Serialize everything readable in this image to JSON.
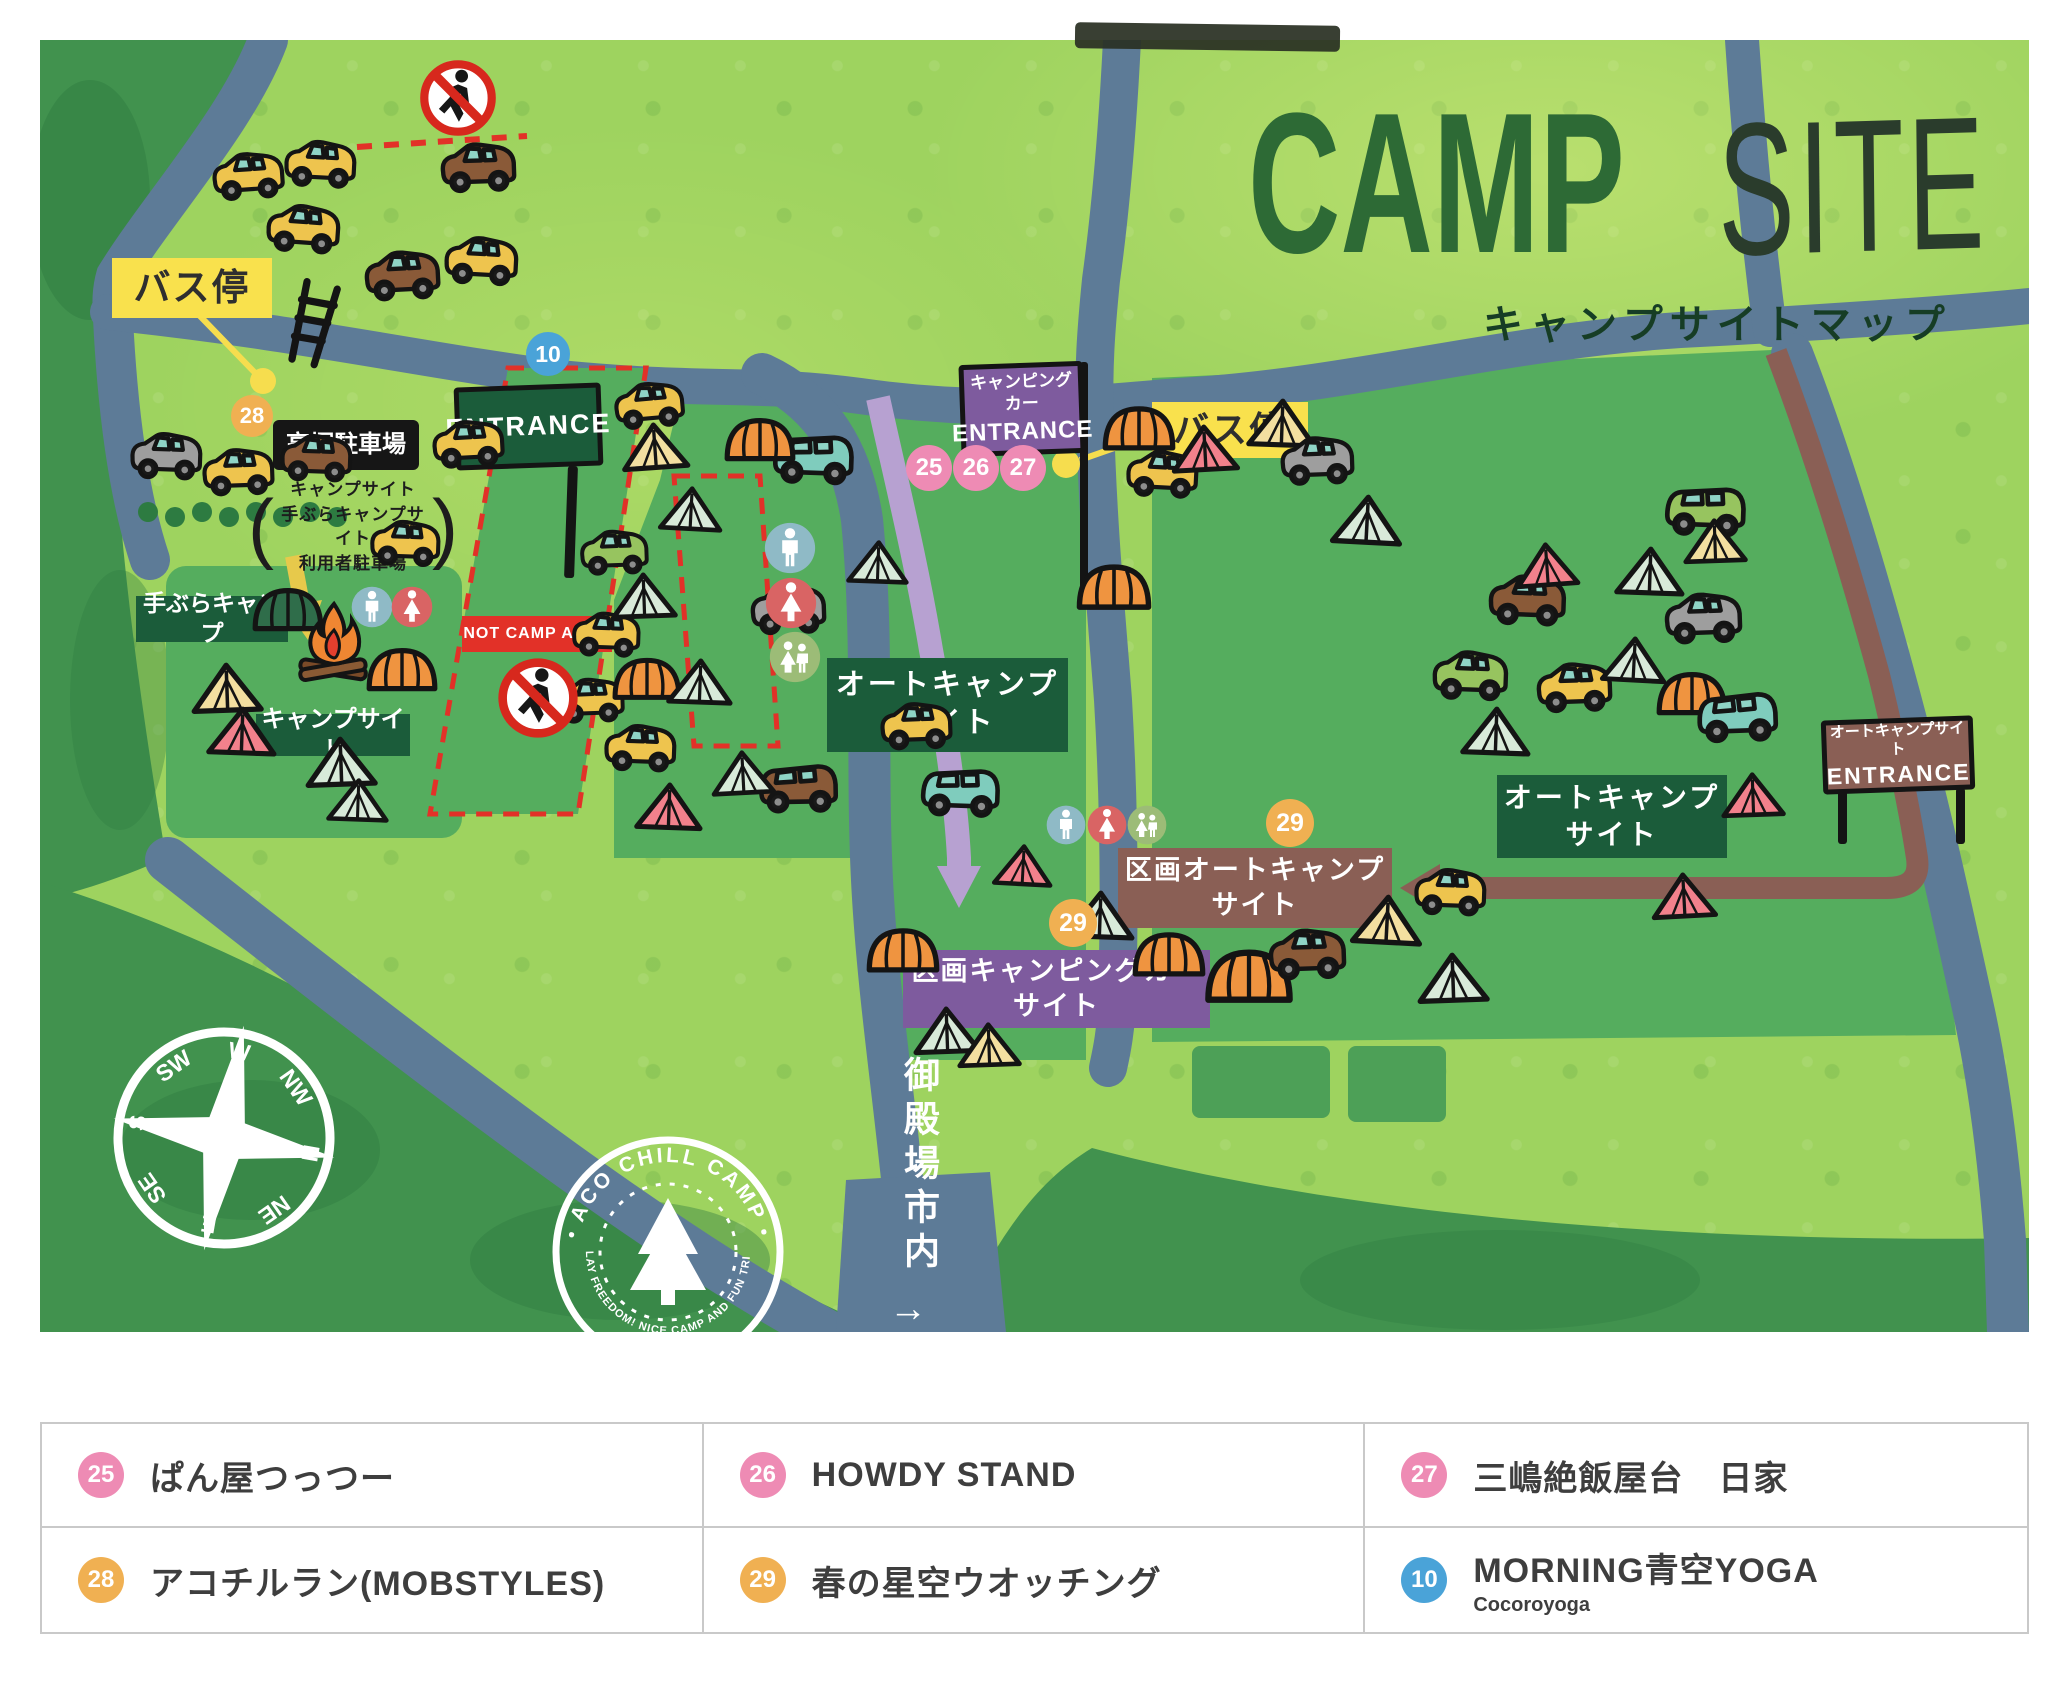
{
  "title": {
    "camp": "CAMP",
    "site": "SITE",
    "subtitle": "キャンプサイトマップ"
  },
  "labels": {
    "bus_stop_left": "バス停",
    "bus_stop_right": "バス停",
    "entrance_main": "ENTRANCE",
    "camper_entrance_line1": "キャンピングカー",
    "camper_entrance_line2": "ENTRANCE",
    "auto_entrance_line1": "オートキャンプサイト",
    "auto_entrance_line2": "ENTRANCE",
    "parking_name": "高塚駐車場",
    "parking_note_line1": "キャンプサイト",
    "parking_note_line2": "手ぶらキャンプサイト",
    "parking_note_line3": "利用者駐車場",
    "paren_open": "(",
    "paren_close": ")",
    "tebura_camp": "手ぶらキャンプ",
    "campsite_area": "キャンプサイト",
    "auto_center_line1": "オートキャンプ",
    "auto_center_line2": "サイト",
    "auto_right_line1": "オートキャンプ",
    "auto_right_line2": "サイト",
    "kukaku_camper_line1": "区画キャンピングカー",
    "kukaku_camper_line2": "サイト",
    "kukaku_auto_line1": "区画オートキャンプ",
    "kukaku_auto_line2": "サイト",
    "not_camp": "NOT CAMP AREA",
    "gotemba": "御殿場市内",
    "gotemba_arrow": "→"
  },
  "colors": {
    "pink": "#ee8bb4",
    "orange": "#f0b052",
    "blue": "#4aa3d8",
    "yellow": "#f6dd4e",
    "green_dark": "#1b5c3a",
    "purple": "#7e5b9e",
    "brown": "#8a5f55",
    "red": "#e23128",
    "road": "#5d7b97",
    "lavender": "#b7a1d1",
    "forest": "#41924e"
  },
  "badges": [
    {
      "label": "10",
      "color": "blue",
      "x": 548,
      "y": 354,
      "d": 44
    },
    {
      "label": "25",
      "color": "pink",
      "x": 929,
      "y": 468,
      "d": 46
    },
    {
      "label": "26",
      "color": "pink",
      "x": 976,
      "y": 468,
      "d": 46
    },
    {
      "label": "27",
      "color": "pink",
      "x": 1023,
      "y": 468,
      "d": 46
    },
    {
      "label": "28",
      "color": "orange",
      "x": 252,
      "y": 416,
      "d": 42
    },
    {
      "label": "29",
      "color": "orange",
      "x": 1073,
      "y": 923,
      "d": 48
    },
    {
      "label": "29",
      "color": "orange",
      "x": 1290,
      "y": 823,
      "d": 48
    }
  ],
  "toilets": [
    {
      "kind": "men",
      "x": 790,
      "y": 548,
      "d": 52
    },
    {
      "kind": "women",
      "x": 791,
      "y": 603,
      "d": 52
    },
    {
      "kind": "family",
      "x": 795,
      "y": 657,
      "d": 52
    },
    {
      "kind": "men",
      "x": 372,
      "y": 607,
      "d": 42
    },
    {
      "kind": "women",
      "x": 412,
      "y": 607,
      "d": 42
    },
    {
      "kind": "men",
      "x": 1066,
      "y": 825,
      "d": 40
    },
    {
      "kind": "women",
      "x": 1107,
      "y": 825,
      "d": 40
    },
    {
      "kind": "family",
      "x": 1147,
      "y": 825,
      "d": 40
    }
  ],
  "no_walk_icons": [
    {
      "x": 458,
      "y": 98,
      "d": 82
    },
    {
      "x": 538,
      "y": 698,
      "d": 86
    }
  ],
  "compass": {
    "directions": [
      "N",
      "NE",
      "E",
      "SE",
      "S",
      "SW",
      "W",
      "NW"
    ]
  },
  "stamp": {
    "arc_top": "・ACO CHILL CAMP・",
    "arc_bottom": "PLAY FREEDOM! NICE CAMP AND FUN TRIP!"
  },
  "legend": {
    "rows": [
      [
        {
          "num": "25",
          "color": "pink",
          "text": "ぱん屋つっつー"
        },
        {
          "num": "26",
          "color": "pink",
          "text": "HOWDY STAND"
        },
        {
          "num": "27",
          "color": "pink",
          "text": "三嶋絶飯屋台　日家"
        }
      ],
      [
        {
          "num": "28",
          "color": "orange",
          "text": "アコチルラン(MOBSTYLES)"
        },
        {
          "num": "29",
          "color": "orange",
          "text": "春の星空ウオッチング"
        },
        {
          "num": "10",
          "color": "blue",
          "text": "MORNING青空YOGA",
          "sub": "Cocoroyoga"
        }
      ]
    ]
  },
  "icons": [
    [
      "car",
      "y",
      208,
      146,
      80,
      -4
    ],
    [
      "car",
      "y",
      280,
      134,
      80,
      3
    ],
    [
      "car",
      "b",
      436,
      136,
      84,
      -2
    ],
    [
      "car",
      "y",
      262,
      198,
      82,
      4
    ],
    [
      "car",
      "b",
      360,
      244,
      84,
      -3
    ],
    [
      "car",
      "y",
      440,
      230,
      82,
      3
    ],
    [
      "car",
      "g",
      126,
      426,
      80,
      2
    ],
    [
      "car",
      "y",
      198,
      442,
      80,
      -2
    ],
    [
      "car",
      "b",
      276,
      428,
      80,
      2
    ],
    [
      "car",
      "y",
      428,
      414,
      80,
      -3
    ],
    [
      "car",
      "y",
      366,
      514,
      78,
      2
    ],
    [
      "car",
      "gr",
      576,
      524,
      76,
      -2
    ],
    [
      "car",
      "y",
      568,
      606,
      76,
      2
    ],
    [
      "car",
      "y",
      552,
      672,
      76,
      -2
    ],
    [
      "car",
      "y",
      610,
      376,
      78,
      -5
    ],
    [
      "van",
      "t",
      768,
      424,
      90,
      2
    ],
    [
      "dome",
      "o",
      722,
      412,
      76,
      0
    ],
    [
      "tent",
      "c",
      620,
      420,
      70,
      -4
    ],
    [
      "tent",
      "m",
      658,
      484,
      66,
      3
    ],
    [
      "tent",
      "m",
      610,
      570,
      68,
      -2
    ],
    [
      "dome",
      "o",
      610,
      652,
      74,
      0
    ],
    [
      "tent",
      "m",
      666,
      656,
      68,
      2
    ],
    [
      "car",
      "g",
      746,
      578,
      84,
      -2
    ],
    [
      "car",
      "y",
      600,
      718,
      80,
      2
    ],
    [
      "van",
      "b",
      754,
      754,
      88,
      -1
    ],
    [
      "tent",
      "p",
      634,
      780,
      70,
      2
    ],
    [
      "tent",
      "m",
      710,
      748,
      66,
      -3
    ],
    [
      "tent",
      "m",
      846,
      538,
      64,
      2
    ],
    [
      "car",
      "y",
      876,
      696,
      80,
      -2
    ],
    [
      "van",
      "t",
      916,
      758,
      88,
      2
    ],
    [
      "dome",
      "o",
      864,
      922,
      78,
      0
    ],
    [
      "tent",
      "m",
      912,
      1004,
      70,
      -2
    ],
    [
      "tent",
      "p",
      992,
      842,
      62,
      3
    ],
    [
      "tent",
      "c",
      956,
      1020,
      66,
      -2
    ],
    [
      "dome",
      "o",
      1100,
      400,
      78,
      0
    ],
    [
      "car",
      "y",
      1122,
      444,
      80,
      3
    ],
    [
      "tent",
      "p",
      1170,
      422,
      70,
      -3
    ],
    [
      "tent",
      "c",
      1246,
      396,
      72,
      2
    ],
    [
      "car",
      "g",
      1276,
      430,
      82,
      -2
    ],
    [
      "tent",
      "m",
      1330,
      492,
      74,
      3
    ],
    [
      "dome",
      "o",
      1074,
      558,
      80,
      0
    ],
    [
      "van",
      "gr",
      1660,
      476,
      90,
      2
    ],
    [
      "tent",
      "c",
      1682,
      516,
      66,
      -2
    ],
    [
      "car",
      "b",
      1484,
      568,
      86,
      2
    ],
    [
      "tent",
      "p",
      1514,
      540,
      66,
      -4
    ],
    [
      "tent",
      "m",
      1614,
      544,
      72,
      2
    ],
    [
      "car",
      "g",
      1660,
      586,
      86,
      -2
    ],
    [
      "car",
      "gr",
      1428,
      644,
      84,
      2
    ],
    [
      "car",
      "y",
      1532,
      656,
      84,
      -2
    ],
    [
      "tent",
      "m",
      1600,
      634,
      68,
      3
    ],
    [
      "dome",
      "o",
      1654,
      666,
      76,
      0
    ],
    [
      "van",
      "t",
      1692,
      682,
      90,
      -2
    ],
    [
      "tent",
      "m",
      1460,
      704,
      72,
      2
    ],
    [
      "tent",
      "p",
      1720,
      770,
      66,
      -2
    ],
    [
      "tent",
      "m",
      1064,
      888,
      72,
      2
    ],
    [
      "dome",
      "o",
      1130,
      926,
      78,
      0
    ],
    [
      "dome",
      "o",
      1202,
      942,
      94,
      0
    ],
    [
      "car",
      "b",
      1264,
      922,
      86,
      -2
    ],
    [
      "tent",
      "c",
      1350,
      892,
      74,
      3
    ],
    [
      "tent",
      "m",
      1416,
      950,
      74,
      -2
    ],
    [
      "car",
      "y",
      1410,
      862,
      80,
      2
    ],
    [
      "tent",
      "p",
      1650,
      870,
      68,
      -3
    ],
    [
      "dome",
      "dg",
      250,
      582,
      76,
      0
    ],
    [
      "fire",
      "",
      294,
      600,
      80,
      0
    ],
    [
      "dome",
      "o",
      364,
      642,
      76,
      0
    ],
    [
      "tent",
      "c",
      190,
      660,
      74,
      -2
    ],
    [
      "tent",
      "p",
      206,
      704,
      72,
      2
    ],
    [
      "tent",
      "m",
      304,
      734,
      74,
      -2
    ],
    [
      "tent",
      "m",
      326,
      776,
      64,
      2
    ],
    [
      "ladder",
      "",
      284,
      280,
      56,
      14
    ]
  ]
}
